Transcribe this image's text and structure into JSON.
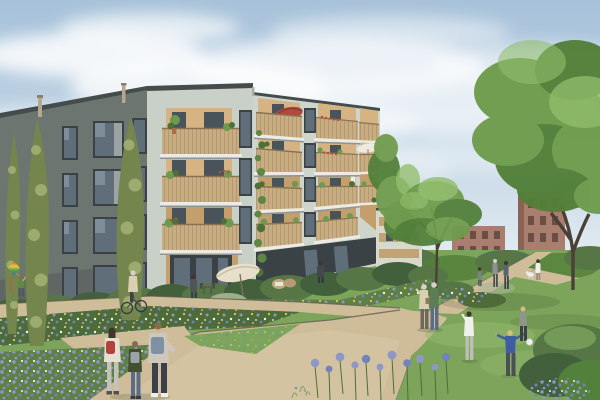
{
  "scene": {
    "kind": "architectural-exterior-rendering",
    "description": "Sage-green apartment building with timber balconies beside a wildflower meadow, gravel paths and playing children",
    "figures": [
      "child-flying-kite",
      "woman-cycling",
      "man-on-terrace",
      "man-at-ground-floor-door",
      "three-children-walking",
      "elderly-couple-walking",
      "girl-in-white-playing",
      "boy-in-blue-throwing-ball",
      "blonde-girl-playing",
      "pedestrian-pair-on-path",
      "woman-walking-dog",
      "woman-on-upper-balcony",
      "woman-on-right-balcony"
    ],
    "objects": [
      "apartment-building",
      "recessed-timber-balconies",
      "red-parasol",
      "cream-patio-umbrella",
      "white-parasol",
      "cypress-trees",
      "climbing-vine",
      "hedge",
      "wildflower-meadow",
      "gravel-paths",
      "lawn",
      "large-tree",
      "center-tree",
      "brick-buildings",
      "rainbow-kite",
      "white-ball"
    ]
  },
  "colors": {
    "sky_top": "#a6c1d9",
    "sky_mid": "#c3d6e5",
    "sky_horizon": "#e6eef3",
    "cloud": "#ffffff",
    "facade_front": "#c9d0c8",
    "facade_front_right": "#ced5cc",
    "facade_side": "#6d7571",
    "parapet": "#454c4c",
    "step_shadow": "#a8afa7",
    "window_frame": "#3a4246",
    "window_glass": "#5f6e78",
    "window_glass_light": "#8a9aa6",
    "wood_back": "#c49e6b",
    "wood_back_light": "#d5b383",
    "railing_wood": "#c9ad82",
    "railing_line": "#a3875f",
    "handrail": "#8a7354",
    "soffit": "#eceae2",
    "slab_shadow": "#8f968f",
    "door_dark": "#49535a",
    "vine_green": "#5d8743",
    "plant_green": "#6b9a50",
    "plant_dark": "#4c7038",
    "flower_red": "#c2493b",
    "hedge_dark": "#43603c",
    "hedge_mid": "#567646",
    "shrub_pale": "#a9b694",
    "meadow_base": "#5f8045",
    "meadow_dark": "#4e6c3a",
    "lawn": "#7ca45b",
    "lawn_light": "#93b96d",
    "path": "#cfbd99",
    "path_light": "#d9c9a7",
    "path_edge": "#5f594e",
    "flower_lavender": "#8e97c6",
    "flower_blue": "#6f83bd",
    "flower_white": "#f3f3ec",
    "flower_yellow": "#d9c95e",
    "flower_pink": "#c590a8",
    "tree_mid": "#6f9c4d",
    "tree_dark": "#53803a",
    "tree_light": "#90bd69",
    "trunk": "#4b4036",
    "cypress_light": "#9cab6e",
    "cypress_dark": "#74854e",
    "brick": "#a97e6e",
    "brick_dark": "#8a6355",
    "brick_window": "#6b4f45",
    "roof_grey": "#9aa1a5",
    "wing_facade": "#d7d9cd",
    "wing_wood": "#c3a273",
    "umbrella_red": "#b3473c",
    "umbrella_cream": "#e7dfc9",
    "umbrella_white": "#edebe0",
    "kite_red": "#d84b3a",
    "kite_yellow": "#e8c93f",
    "kite_green": "#4d9e4a",
    "kite_blue": "#3f6fc1",
    "skin": "#caa284",
    "hair_dark": "#42362a",
    "hair_grey": "#d6d2c9",
    "hair_blonde": "#d8bd7d",
    "hair_brown": "#8a6b4a",
    "jacket_girl": "#e6e0d3",
    "backpack_red": "#b5413c",
    "jacket_boy": "#42502f",
    "backpack_grey": "#9ba3a9",
    "hoodie_tall": "#cdc8bb",
    "backpack_blue": "#7e90a3",
    "jeans": "#5b6c87",
    "pants_dark": "#3b404b",
    "pants_light": "#c4c2bb",
    "top_beige": "#dbcfb2",
    "shirt_plaid": "#5f7d54",
    "tee_blue": "#3e5ea1",
    "top_white": "#f0f0ec",
    "top_green": "#5d8a4a",
    "figure_grey": "#8e9297",
    "figure_navy": "#5a6470",
    "shadow": "#2c3524"
  }
}
